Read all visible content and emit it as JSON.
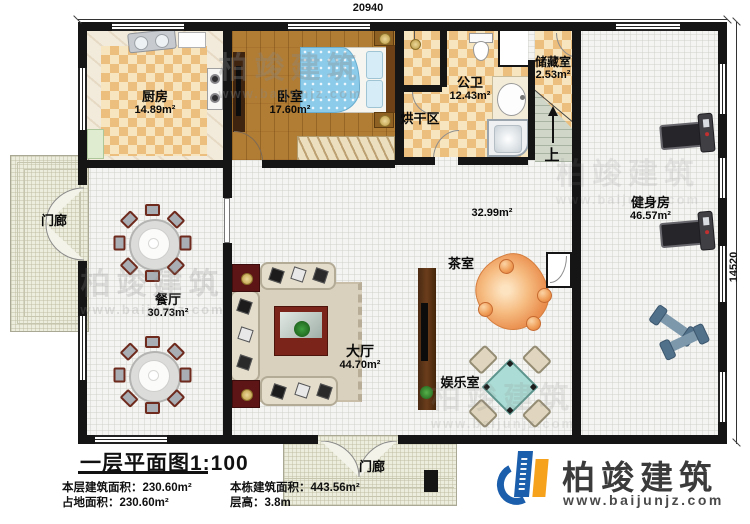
{
  "dimensions": {
    "width_label": "20940",
    "height_label": "14520"
  },
  "rooms": {
    "kitchen": {
      "label": "厨房",
      "area": "14.89m²"
    },
    "bedroom": {
      "label": "卧室",
      "area": "17.60m²"
    },
    "bathroom": {
      "label": "公卫",
      "area": "12.43m²"
    },
    "drying": {
      "label": "烘干区"
    },
    "storage": {
      "label": "储藏室",
      "area": "2.53m²"
    },
    "stairs": {
      "label": "上"
    },
    "gym": {
      "label": "健身房",
      "area": "46.57m²"
    },
    "corridor": {
      "area": "32.99m²"
    },
    "dining": {
      "label": "餐厅",
      "area": "30.73m²"
    },
    "hall": {
      "label": "大厅",
      "area": "44.70m²"
    },
    "tea": {
      "label": "茶室"
    },
    "entertainment": {
      "label": "娱乐室"
    },
    "porch_left": {
      "label": "门廊"
    },
    "porch_bottom": {
      "label": "门廊"
    }
  },
  "title_block": {
    "title": "一层平面图1:100",
    "stats": {
      "floor_area_label": "本层建筑面积：",
      "floor_area_value": "230.60m²",
      "building_area_label": "本栋建筑面积：",
      "building_area_value": "443.56m²",
      "footprint_label": "占地面积：",
      "footprint_value": "230.60m²",
      "floor_height_label": "层高：",
      "floor_height_value": "3.8m"
    }
  },
  "logo": {
    "name": "柏竣建筑",
    "website": "www.baijunjz.com"
  },
  "watermark": {
    "name": "柏竣建筑",
    "website": "www.baijunjz.com"
  },
  "colors": {
    "wall": "#151515",
    "checker_dark": "#ecbf7e",
    "checker_light": "#f7e5bf",
    "wood_floor": "#b17c33",
    "logo_blue": "#1b5eab",
    "logo_orange": "#f6a21c"
  }
}
